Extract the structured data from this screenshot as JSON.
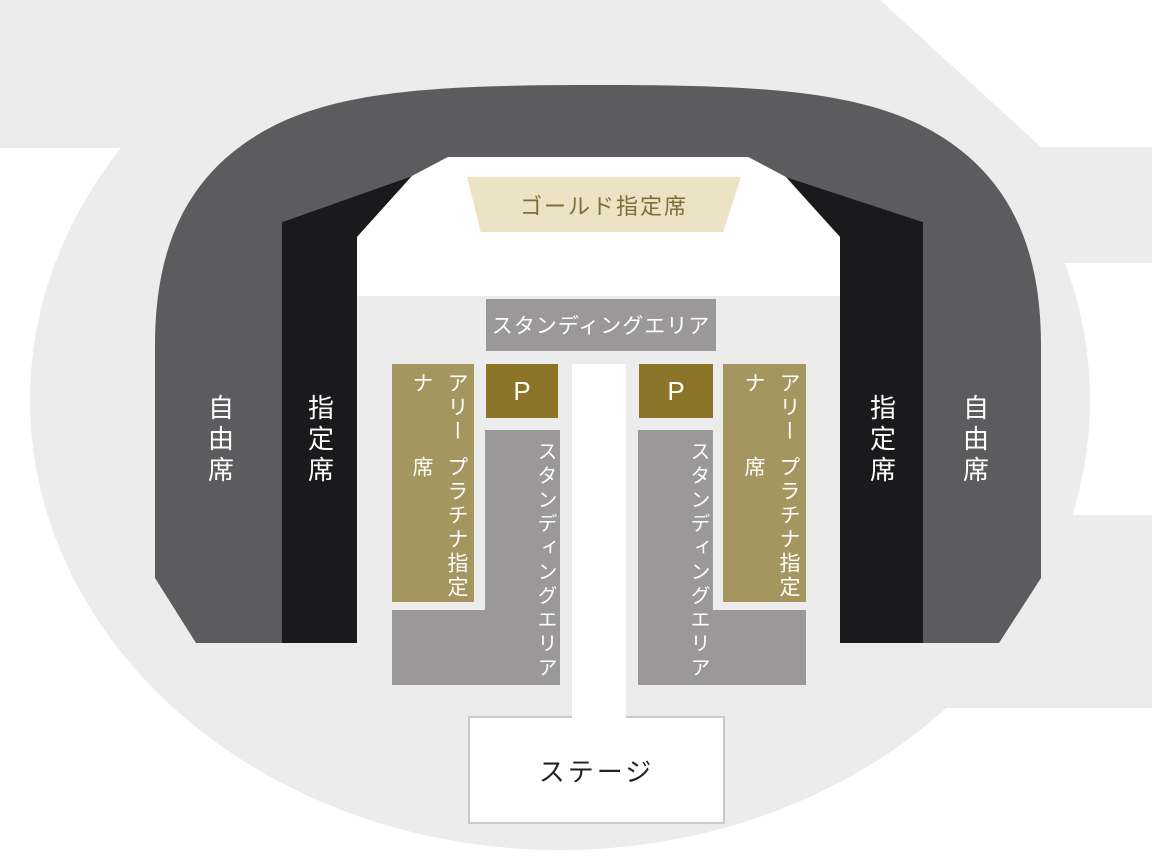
{
  "venue_map": {
    "labels": {
      "gold_reserved": "ゴールド指定席",
      "standing_area": "スタンディングエリア",
      "premium_block": "P",
      "arena_platinum_line1": "アリーナ",
      "arena_platinum_line2": "プラチナ指定席",
      "reserved_seating": "指定席",
      "free_seating": "自由席",
      "stage": "ステージ"
    },
    "colors": {
      "page_background": "#FFFFFF",
      "floor": "#ECECEC",
      "free_seating_band": "#5C5C5E",
      "reserved_seating_band": "#1A1A1C",
      "gold_banner_bg": "#ECE3C4",
      "gold_banner_text": "#7D6D38",
      "standing_area_bg": "#9A9898",
      "premium_block_bg": "#8C7528",
      "arena_platinum_bg": "#A4965E",
      "stage_bg": "#FFFFFF",
      "stage_border": "#C9C9C9",
      "stage_text": "#222222"
    }
  }
}
